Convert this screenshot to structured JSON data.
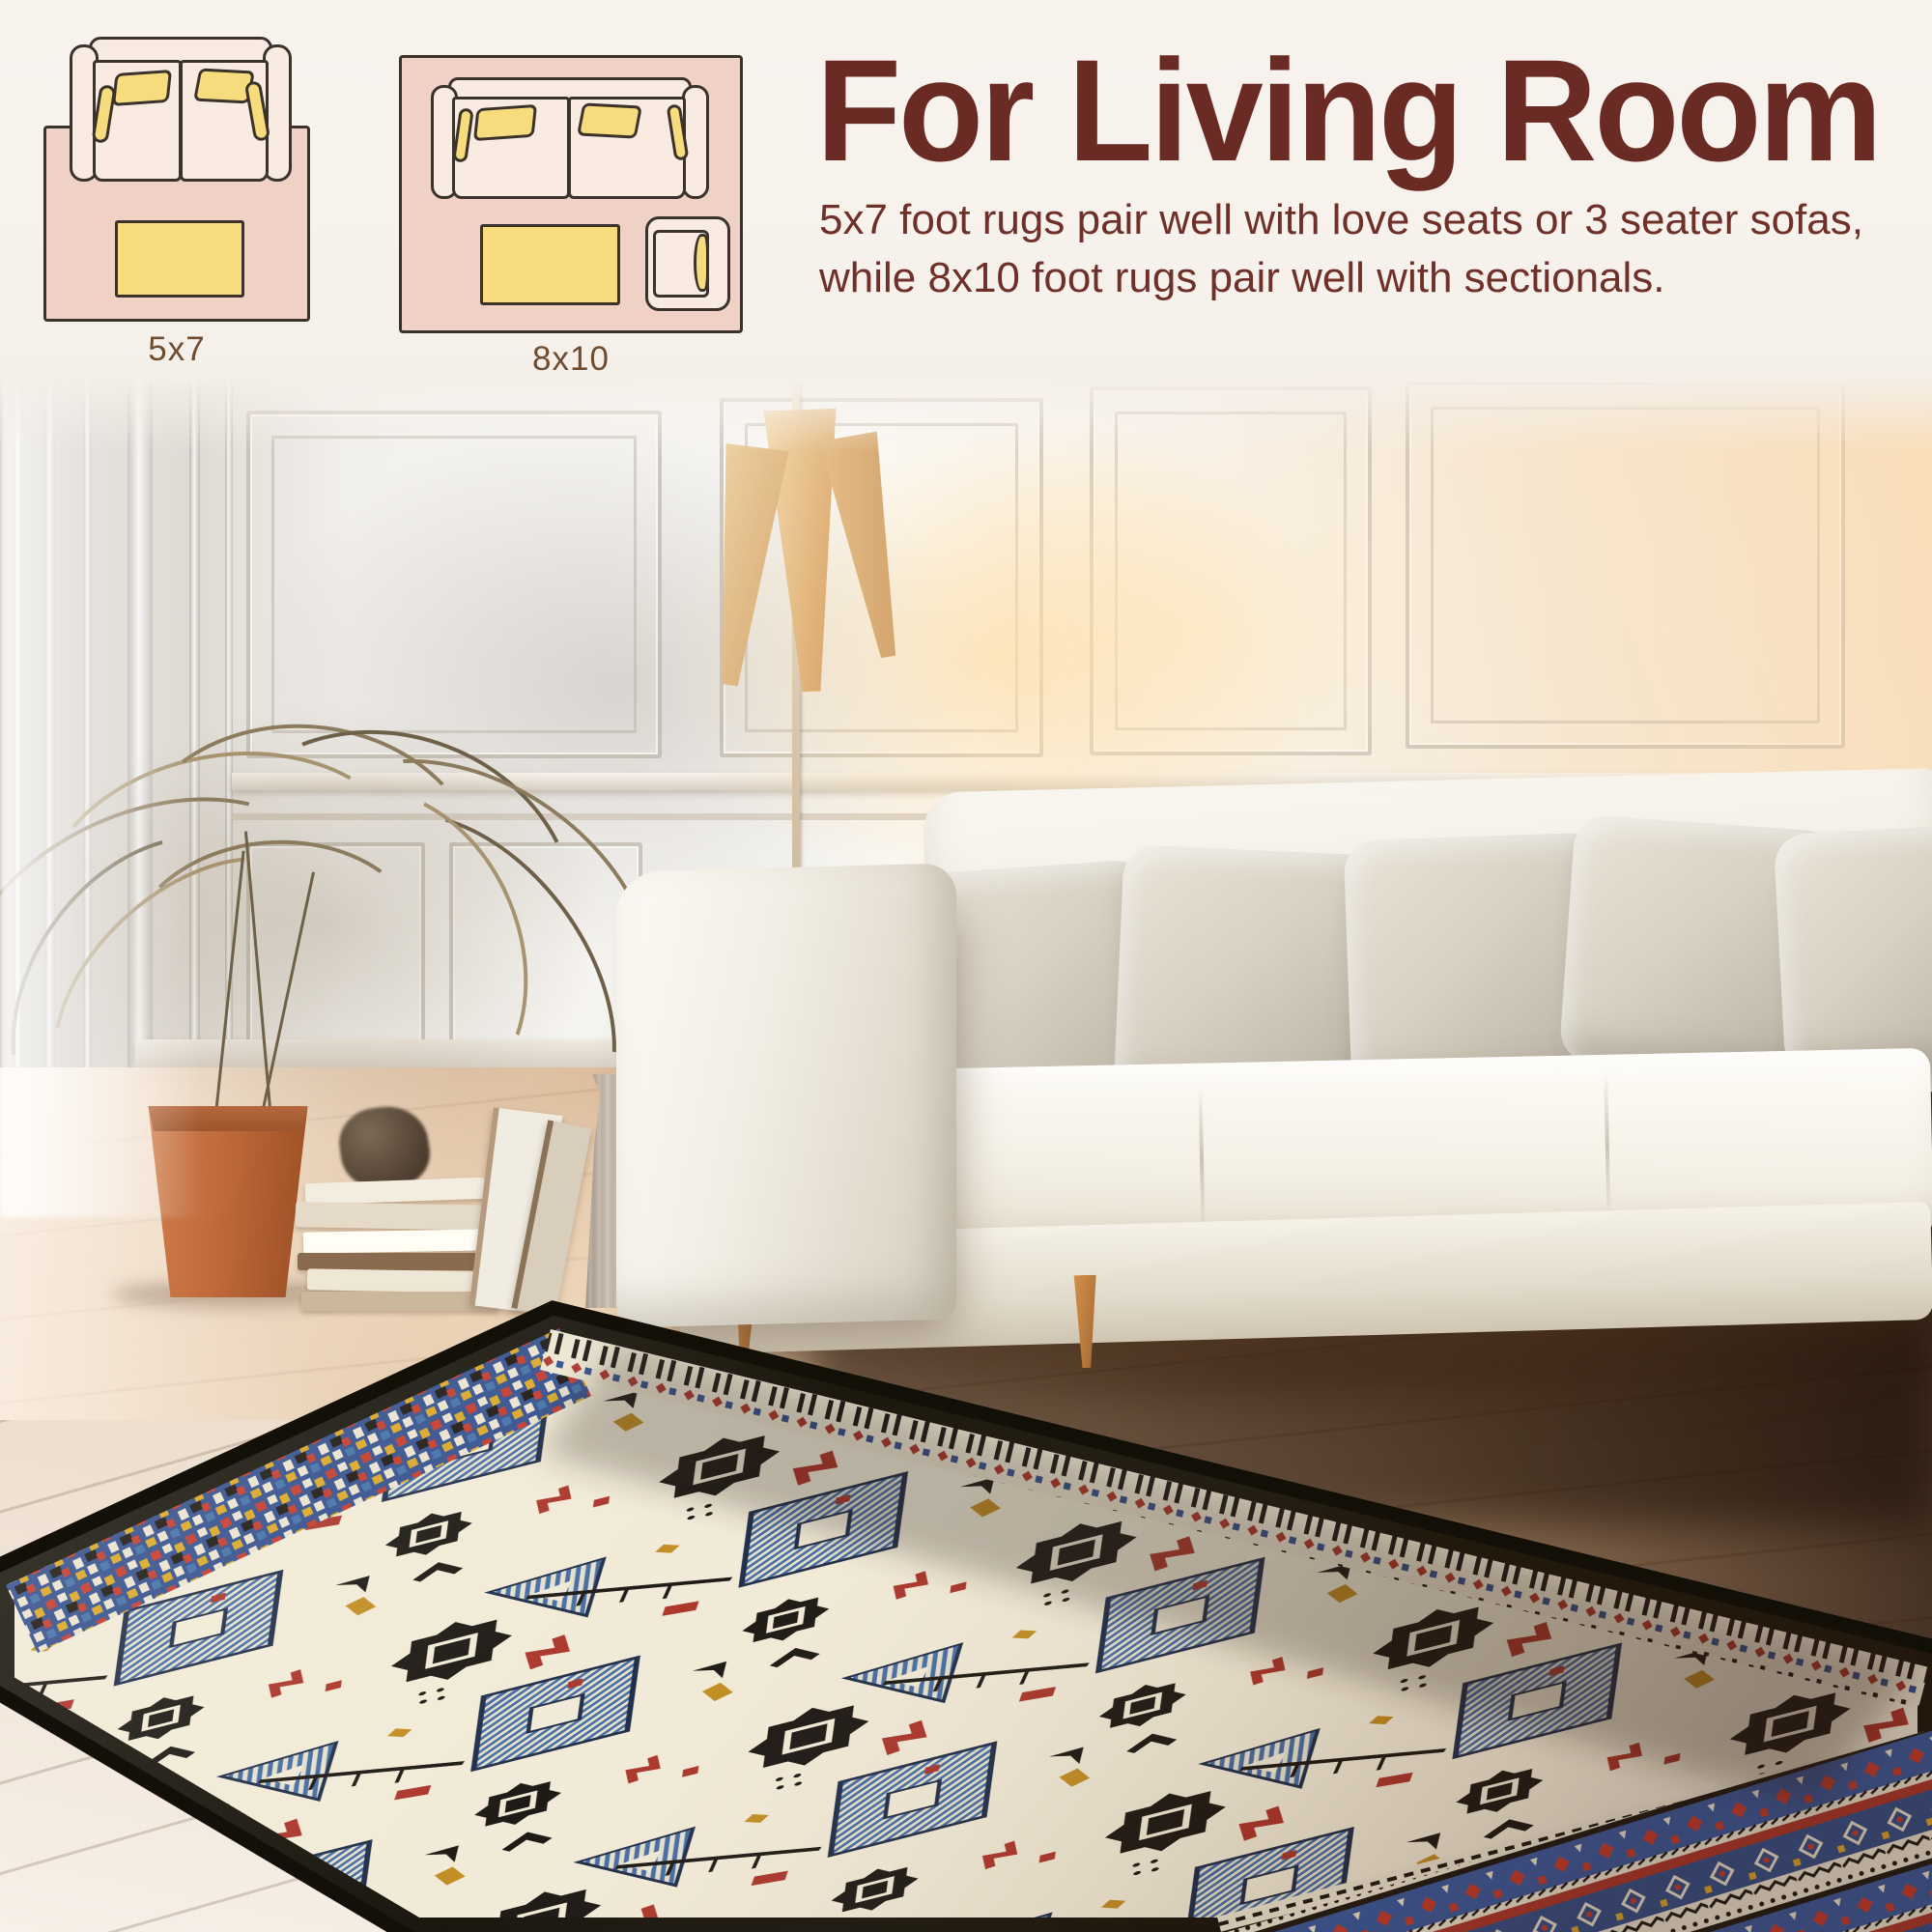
{
  "header": {
    "title": "For Living Room",
    "description": "5x7 foot rugs pair well with love seats or 3 seater sofas, while 8x10 foot rugs pair well with sectionals.",
    "accent_color": "#6a2b24",
    "background_color": "#f8f2ed"
  },
  "size_guide": {
    "diagrams": [
      {
        "label": "5x7",
        "furniture": [
          "loveseat sofa",
          "coffee table"
        ],
        "rug_color": "#efd2c5",
        "sofa_color": "#faebe2",
        "pillow_color": "#f7dc7d",
        "outline_color": "#3a332c",
        "label_color": "#6f4c2f"
      },
      {
        "label": "8x10",
        "furniture": [
          "3 seater sofa",
          "coffee table",
          "armchair"
        ],
        "rug_color": "#efd2c5",
        "sofa_color": "#faebe2",
        "pillow_color": "#f7dc7d",
        "outline_color": "#3a332c",
        "label_color": "#6f4c2f"
      }
    ]
  },
  "photo": {
    "scene_elements": [
      "paneled wall",
      "floor lamp with three cone shades",
      "dried palm plant in terracotta pot",
      "stacked books",
      "gray vase",
      "cream sofa with five beige pillows",
      "wood plank floor",
      "tribal kilim area rug"
    ],
    "rug_palette": {
      "field": "#f1ead7",
      "motif_black": "#17130f",
      "motif_blue": "#41699f",
      "motif_red": "#a93127",
      "motif_gold": "#c08a1e",
      "border_black": "#131008",
      "band_blue": "#2f4c8c",
      "band_red": "#c23629",
      "band_cream": "#ece5d2"
    }
  }
}
